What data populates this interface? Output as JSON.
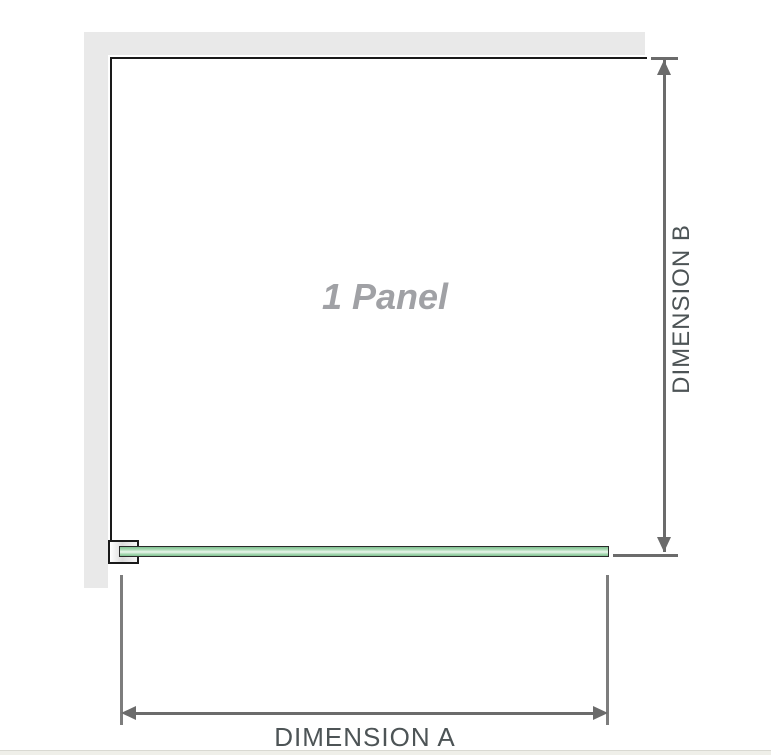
{
  "diagram": {
    "panel_label": "1 Panel",
    "dimension_a_label": "DIMENSION A",
    "dimension_b_label": "DIMENSION B"
  },
  "colors": {
    "wall": "#e9e9e9",
    "panel-outline": "#1a1a1a",
    "dim-line": "#6b6b6b",
    "ext-line": "#7d7d7d",
    "label-text": "#4d5456",
    "panel-text": "#a0a1a5",
    "glass-dark": "#7fc190",
    "glass-mid": "#a8d9b3",
    "glass-light": "#ecf7ee",
    "glass-border": "#2a2a2a",
    "footer-strip": "#efefe9"
  }
}
